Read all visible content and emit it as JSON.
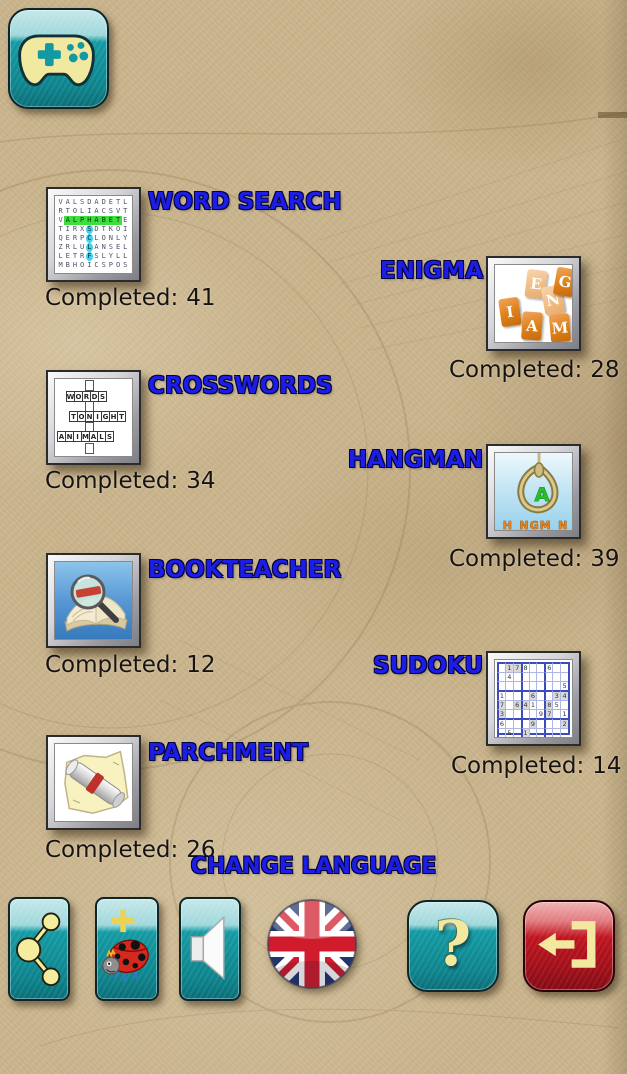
{
  "colors": {
    "label_blue": "#1d1de8",
    "teal_button": "#12929b",
    "red_button": "#a80f18",
    "parchment_bg": "#c9b48c"
  },
  "labels": {
    "completed": "Completed:",
    "change_language": "CHANGE LANGUAGE"
  },
  "games": {
    "word_search": {
      "label": "WORD SEARCH",
      "completed": "41"
    },
    "enigma": {
      "label": "ENIGMA",
      "completed": "28"
    },
    "crosswords": {
      "label": "CROSSWORDS",
      "completed": "34"
    },
    "hangman": {
      "label": "HANGMAN",
      "completed": "39"
    },
    "bookteacher": {
      "label": "BOOKTEACHER",
      "completed": "12"
    },
    "sudoku": {
      "label": "SUDOKU",
      "completed": "14"
    },
    "parchment": {
      "label": "PARCHMENT",
      "completed": "26"
    }
  },
  "icons": {
    "app_logo": "gamepad-icon",
    "word_search_grid": {
      "rows": [
        "VALSDADETL",
        "RTOLIACSVT",
        "VALPHABETE",
        "TIRXSDTKOI",
        "QERPCLONLY",
        "ZRLULANSEL",
        "LETRFSLYLL",
        "MBHOICSPOS"
      ],
      "highlight_row": {
        "row": 2,
        "from": 1,
        "to": 8
      },
      "highlight_cells": [
        [
          3,
          4
        ],
        [
          4,
          4
        ],
        [
          5,
          4
        ],
        [
          6,
          4
        ]
      ]
    },
    "crosswords_words": [
      "WORDS",
      "TONIGHT",
      "ANIMALS"
    ],
    "enigma_tiles": [
      {
        "ch": "I",
        "x": 5,
        "y": 33,
        "r": -8,
        "shade": "dark"
      },
      {
        "ch": "E",
        "x": 31,
        "y": 5,
        "r": 7,
        "shade": "light"
      },
      {
        "ch": "N",
        "x": 48,
        "y": 21,
        "r": -10,
        "shade": "light"
      },
      {
        "ch": "G",
        "x": 60,
        "y": 3,
        "r": 10,
        "shade": "dark"
      },
      {
        "ch": "A",
        "x": 27,
        "y": 47,
        "r": 4,
        "shade": "dark"
      },
      {
        "ch": "M",
        "x": 55,
        "y": 49,
        "r": -5,
        "shade": "dark"
      }
    ],
    "hangman": {
      "letter": "A",
      "masked_word": "H_NGM_N"
    },
    "sudoku_grid": [
      "_178__6__",
      "_4_______",
      "________5",
      "1___6__34",
      "7_641_85_",
      "3____97_1",
      "6___9___2",
      "_5_1_____",
      "_7___4_8_"
    ],
    "toolbar": [
      {
        "name": "share-button",
        "icon": "share-icon"
      },
      {
        "name": "ladybug-button",
        "icon": "ladybug-plus-icon"
      },
      {
        "name": "sound-button",
        "icon": "speaker-icon"
      },
      {
        "name": "language-button",
        "icon": "uk-flag-icon"
      },
      {
        "name": "help-button",
        "icon": "question-mark-icon",
        "glyph": "?"
      },
      {
        "name": "exit-button",
        "icon": "exit-arrow-icon"
      }
    ]
  }
}
